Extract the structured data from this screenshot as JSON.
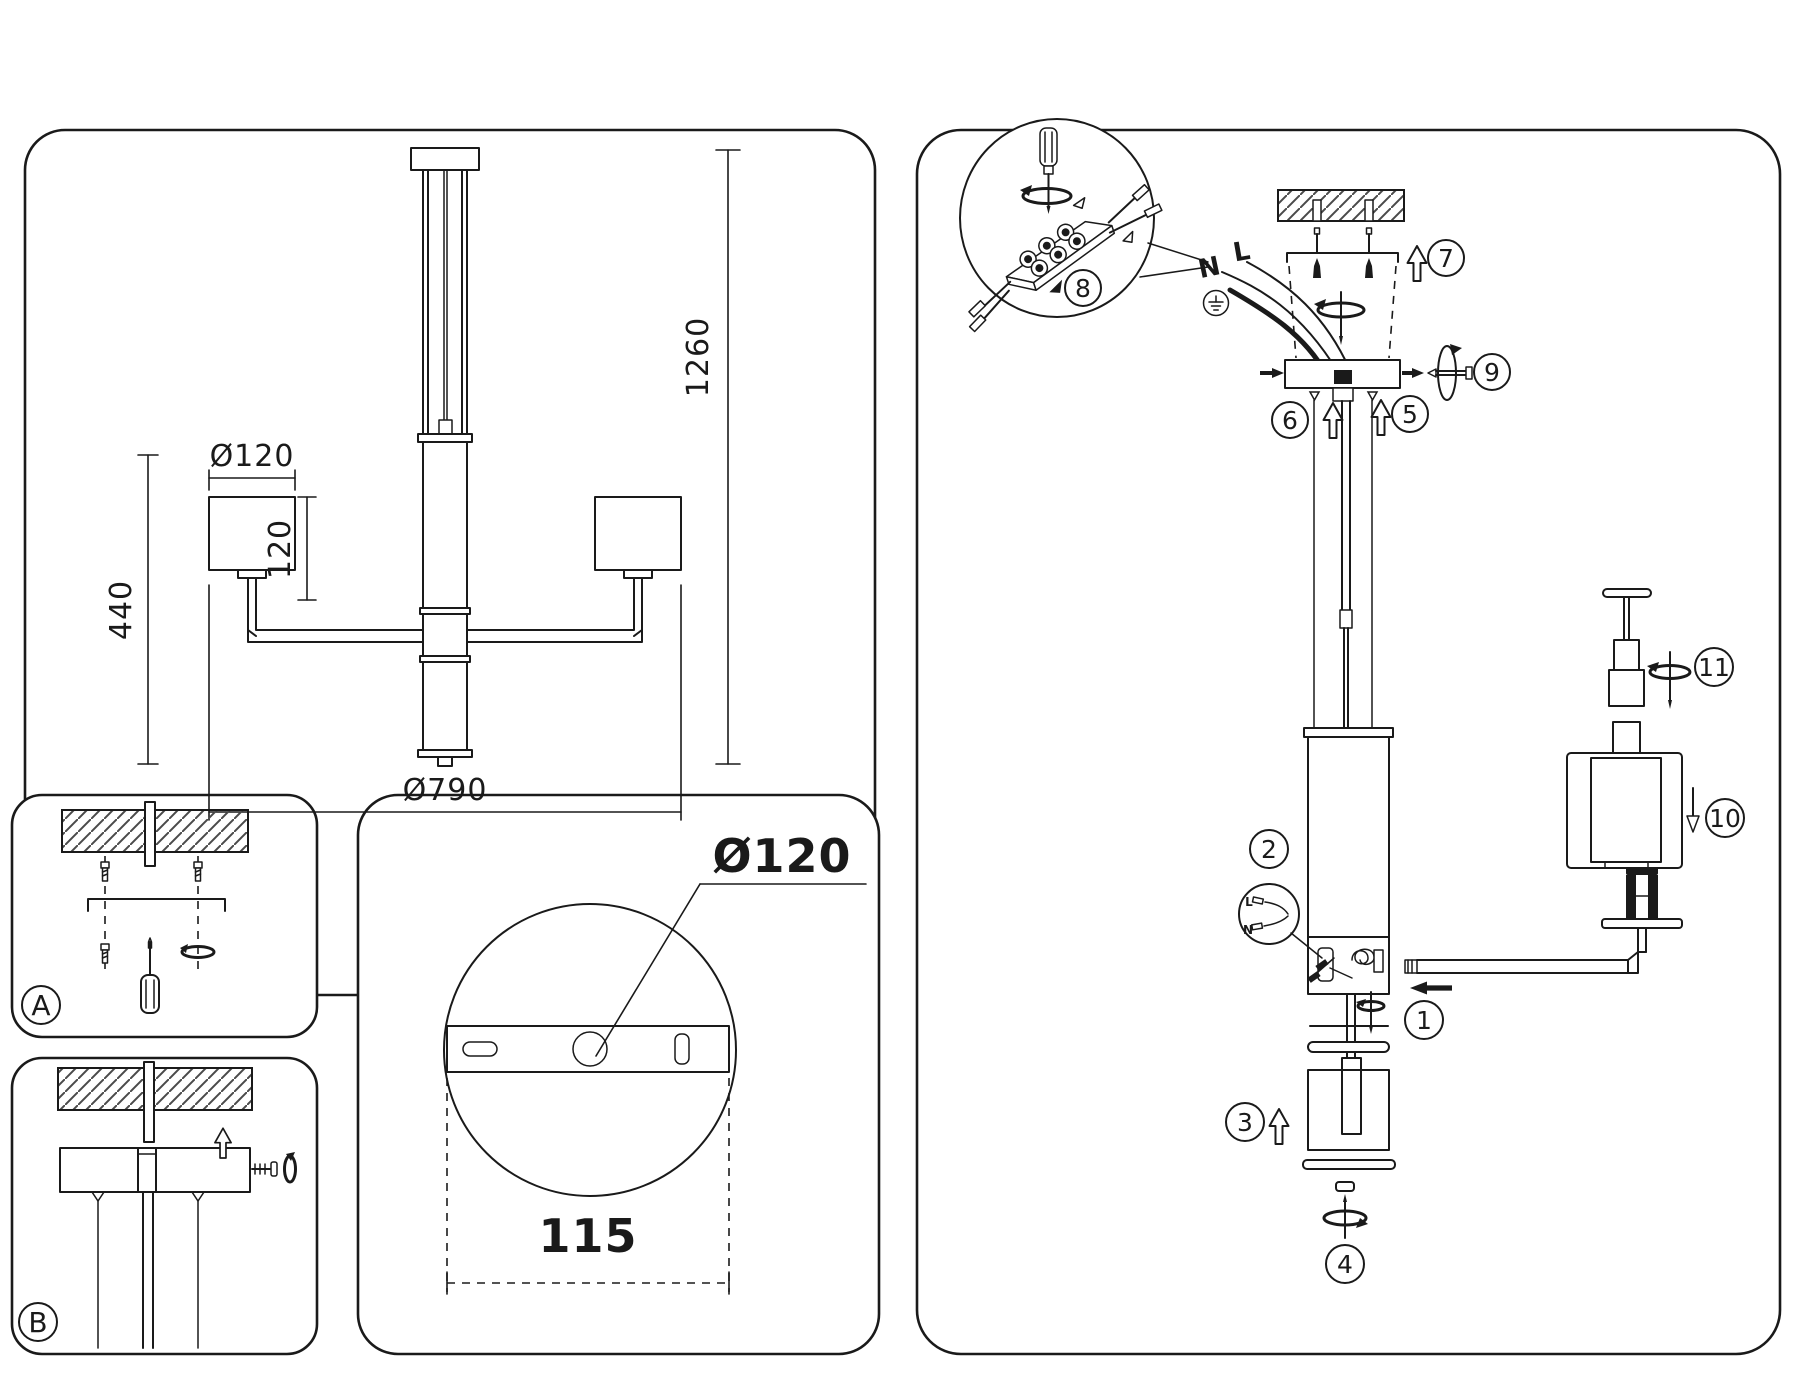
{
  "colors": {
    "ink": "#1a1a1a",
    "paper": "#ffffff"
  },
  "front_view": {
    "shade_diameter": "Ø120",
    "left_height": "440",
    "shade_height": "120",
    "overall_height": "1260",
    "overall_diameter": "Ø790"
  },
  "mount_steps": {
    "a": "A",
    "b": "B"
  },
  "canopy_view": {
    "diameter": "Ø120",
    "spacing": "115"
  },
  "assembly": {
    "wire_n": "N",
    "wire_l": "L",
    "mini_l": "L",
    "mini_n": "N",
    "steps": [
      "1",
      "2",
      "3",
      "4",
      "5",
      "6",
      "7",
      "8",
      "9",
      "10",
      "11"
    ]
  }
}
